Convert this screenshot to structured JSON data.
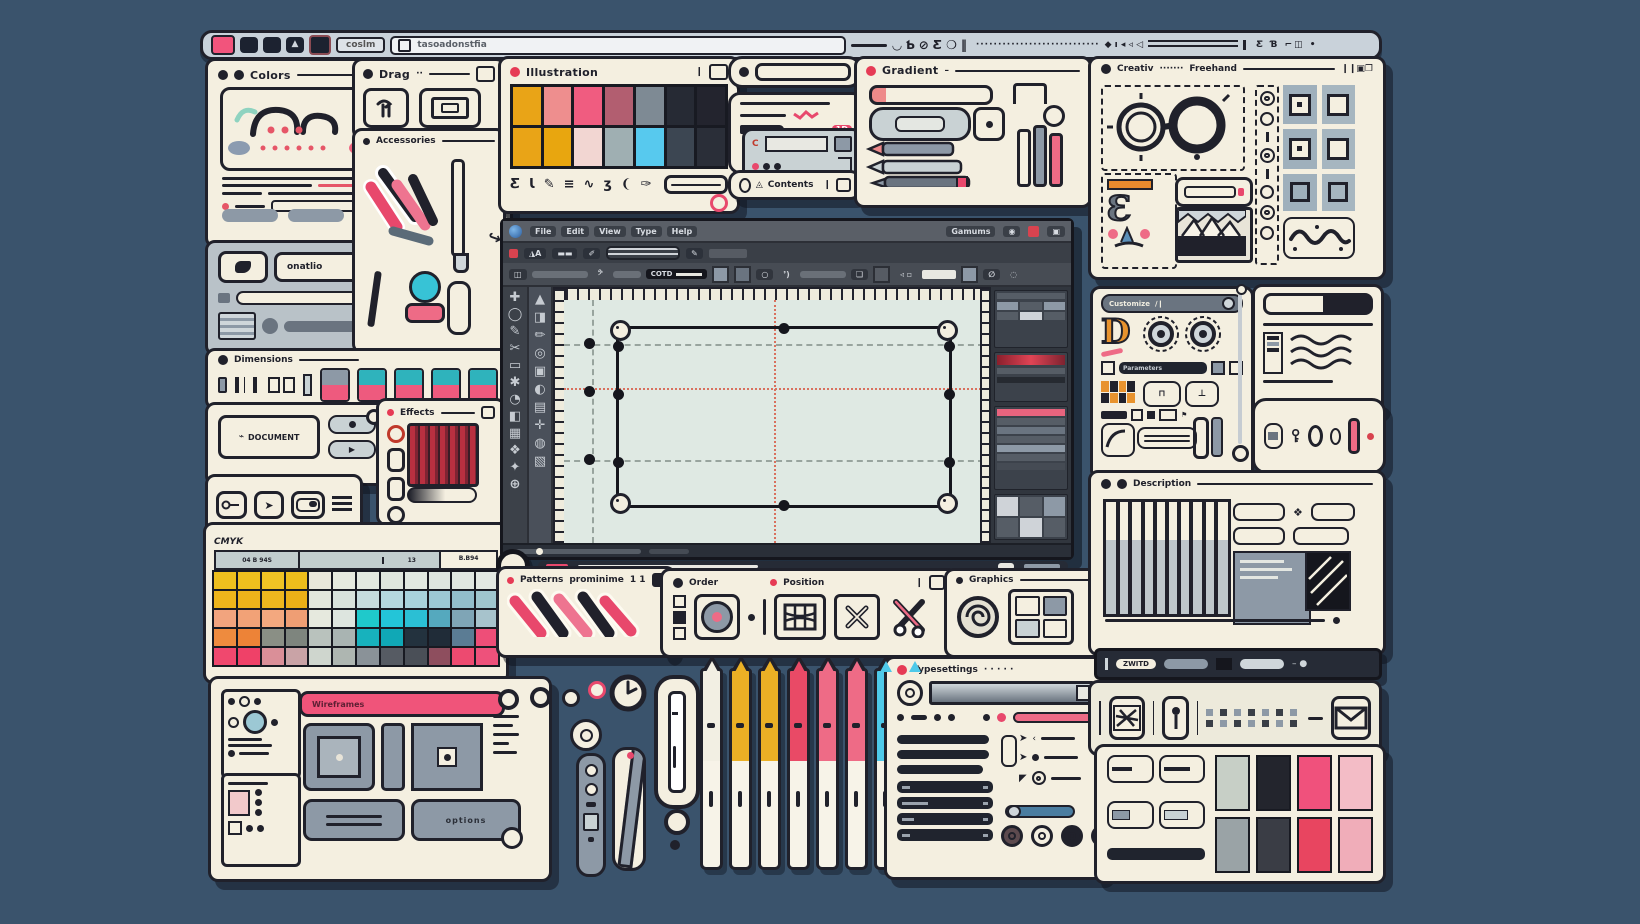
{
  "page": {
    "bg": "#3A536C"
  },
  "topbar": {
    "field": "coslm",
    "address": "tasoadonstfia",
    "icons": [
      "◡",
      "Ƅ",
      "⊘",
      "Ƹ",
      "❍",
      "‖"
    ],
    "dots": "····························",
    "arrows": "◆ ı ◂ ◃ ◁",
    "right_group": "Ƹ Ɓ ⌐◫ •"
  },
  "colors_panel": {
    "title": "Colors"
  },
  "media_panel": {
    "label": "onatlio"
  },
  "drag_panel": {
    "title": "Drag"
  },
  "accessories_panel": {
    "title": "Accessories"
  },
  "swatches_panel": {
    "title": "Illustration",
    "row1": [
      "#E9A417",
      "#EE8E8E",
      "#F05C80",
      "#B25E70",
      "#7E8A94",
      "#262A34",
      "#23242E"
    ],
    "row2": [
      "#E9A417",
      "#E8A60F",
      "#F2D6D2",
      "#9FAFB2",
      "#57C9EE",
      "#3C4652",
      "#2A2E38"
    ],
    "glyphs": [
      "Ƹ",
      "Ɩ",
      "✎",
      "≡",
      "∿",
      "ʒ",
      "❨",
      "✑"
    ]
  },
  "notes_card": {
    "badge": "1D"
  },
  "contents_bar": {
    "label": "Contents"
  },
  "gradient_panel": {
    "title": "Gradient"
  },
  "creative_panel": {
    "title": "Creativ",
    "title2": "Freehand",
    "squares": [
      "#9FB0BC",
      "#A6B6C0",
      "#9FB0BC",
      "#A6B6C0",
      "#9FB0BC",
      "#A6B6C0"
    ]
  },
  "customize_panel": {
    "title": "Customize",
    "letter": "D",
    "field": "Parameters"
  },
  "keys_panel": {},
  "description_panel": {
    "title": "Description"
  },
  "pills_bar": {
    "label": "ZWITD"
  },
  "colorgrid_panel": {
    "grid": [
      "#C7CFC6",
      "#23252D",
      "#F0517C",
      "#F3BCC6",
      "#9AA3A6",
      "#3A3D45",
      "#E84560",
      "#F0ADB9"
    ]
  },
  "dimensions_bar": {
    "title": "Dimensions",
    "chip_tops": [
      "#8D99A6",
      "#2FB3BC",
      "#2FB3BC",
      "#2FB3BC",
      "#2FB3BC"
    ],
    "chip_bots": [
      "#EE5A7E",
      "#EE5A7E",
      "#EE5A7E",
      "#EE5A7E",
      "#EE5A7E"
    ]
  },
  "document_panel": {
    "label": "DOCUMENT"
  },
  "effects_panel": {
    "title": "Effects"
  },
  "cmyk_panel": {
    "tab": "CMYK",
    "h1": "04 B 94S",
    "h2": "13",
    "h3": "B.B94",
    "rows": [
      [
        "#EFC01E",
        "#EFC01E",
        "#F0C324",
        "#EEBE1C",
        "#E9E7DA",
        "#E6EADF",
        "#E3E9E0",
        "#DFE6DE",
        "#E1E8E1",
        "#DEE5DF",
        "#E0E7E1",
        "#E3E9E3"
      ],
      [
        "#EEB51B",
        "#EDB31A",
        "#EFB71E",
        "#ECB017",
        "#E2E6DC",
        "#D8E2DC",
        "#C6DCDE",
        "#B5D8DF",
        "#A8D2DC",
        "#9CC8D4",
        "#92BECB",
        "#9FC6CE"
      ],
      [
        "#F2A47E",
        "#F2A277",
        "#F3A87F",
        "#EF9E74",
        "#E6E9DE",
        "#DDE5DF",
        "#1FC9CB",
        "#23C5D8",
        "#2BBFD4",
        "#55A9BE",
        "#7FA5B6",
        "#A7C3CC"
      ],
      [
        "#EE8B3E",
        "#ED8337",
        "#8A8F85",
        "#7E857E",
        "#B9C2BD",
        "#A9B4B2",
        "#17B2BD",
        "#10A8B6",
        "#23323E",
        "#202C38",
        "#5B7C94",
        "#EE4E78"
      ],
      [
        "#F0486E",
        "#EF4168",
        "#DA8F98",
        "#C9A3A6",
        "#CFD6CE",
        "#AEB6B1",
        "#8A9298",
        "#565B63",
        "#4A4F57",
        "#8E4E5E",
        "#ED4A70",
        "#EE517B"
      ]
    ]
  },
  "patterns_panel": {
    "title": "Patterns",
    "subtitle": "prominime",
    "count": "1 1"
  },
  "arrange_panel": {
    "title": "Order",
    "title2": "Position"
  },
  "graphics_panel": {
    "title": "Graphics"
  },
  "typesettings_panel": {
    "title": "Typesettings",
    "dots": "· · · · ·"
  },
  "components_panel": {
    "bar": "Wireframes",
    "button": "options"
  },
  "app": {
    "menus": [
      "File",
      "Edit",
      "View",
      "Type",
      "Help"
    ],
    "right_label": "Gamums",
    "field": "COTD",
    "tools1": [
      "✚",
      "◯",
      "✎",
      "✂",
      "▭",
      "✱",
      "◔",
      "◧",
      "▦",
      "❖",
      "✦",
      "⊕"
    ],
    "tools2": [
      "▲",
      "◨",
      "✏",
      "◎",
      "▣",
      "◐",
      "▤",
      "✛",
      "◍",
      "▧"
    ]
  },
  "pens": {
    "caps": [
      "#F2EFE3",
      "#EBB025",
      "#EBB025",
      "#E94A66",
      "#EE6B86",
      "#EE6B86",
      "#4EC9E9",
      "#4EC9E9"
    ]
  }
}
